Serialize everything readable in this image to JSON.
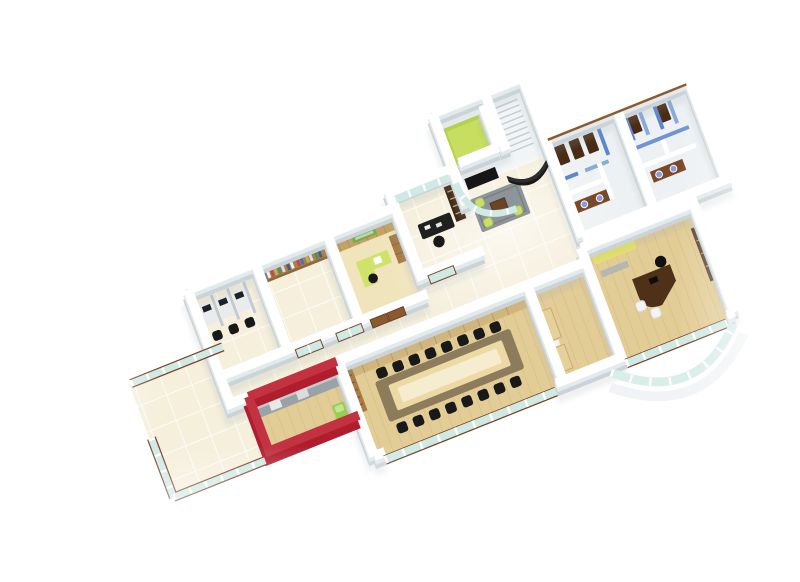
{
  "scene": {
    "description": "3D isometric cutaway render of an office floor plan on a white background, view from above at an angle, edges fading to white",
    "view": "isometric-cutaway",
    "background": "#ffffff"
  },
  "palette": {
    "wallTop": "#ffffff",
    "wallBase": "#c9d3d8",
    "wallShadow": "#9aa6ac",
    "tile": "#f5efdc",
    "grout": "#ffffff",
    "wood": "#e3cd97",
    "plank": "#b98d4e",
    "paleWood": "#f0e4bc",
    "glass": "#cfe9e5",
    "frameBrown": "#7b4426",
    "doorWood": "#8a5a2e",
    "doorWoodDark": "#5e3a1e",
    "furnDark": "#4e3118",
    "furnLight": "#d9b878",
    "furnLightEdge": "#b99a55",
    "shelfWood": "#a87b42",
    "tableTaupe": "#8d7c5c",
    "tableInset": "#ecd9a4",
    "tableCenter": "#f6ecd0",
    "black": "#191919",
    "red": "#b01e2e",
    "redTop": "#c23240",
    "counter": "#9aa2a8",
    "lime": "#b5d44a",
    "limeLight": "#cfe36a",
    "pouf": "#c7e06a",
    "signGreen": "#6fae3c",
    "dispenser": "#97cf52",
    "yellow": "#e9e468",
    "yellowDark": "#cfc84f",
    "blue": "#5d86cc",
    "blueLight": "#88abdd",
    "blueMid": "#6f94d4",
    "sink": "#8a9ae0",
    "toiletFloor": "#eef1f3",
    "whiteFloor": "#f2f5f6",
    "rug": "#8d949a",
    "rugEdge": "#798086",
    "chairWhite": "#f4f4f4",
    "partition": "#c3cad1",
    "deskTop": "#e9ebed",
    "monitor": "#1d2126",
    "steel": "#c5ced4",
    "benchWood": "#e6cf9a",
    "benchEdge": "#c9ab6a"
  },
  "rooms": [
    {
      "id": "workstations",
      "floor": "tile",
      "contents": [
        "3 desks with silver partitions",
        "black monitors",
        "black task chairs"
      ]
    },
    {
      "id": "library",
      "floor": "tile",
      "contents": [
        "full-width wall bookshelf with colored books"
      ]
    },
    {
      "id": "green-office",
      "floor": "pale-wood",
      "contents": [
        "wood panelled wall",
        "green wall sign",
        "lime L-shaped desk",
        "wood cabinet",
        "double wooden door"
      ]
    },
    {
      "id": "private-cabin",
      "floor": "tile",
      "contents": [
        "glazed back wall",
        "dark shelving unit",
        "black desk with papers",
        "glass door"
      ]
    },
    {
      "id": "reception-lounge",
      "floor": "tile",
      "contents": [
        "curved glass partition",
        "gray rug",
        "brown coffee table",
        "3 lime poufs",
        "black curved sofa",
        "dark doorway"
      ]
    },
    {
      "id": "stair-block",
      "floor": "white",
      "contents": [
        "staircase with steps",
        "lime-green landing room"
      ]
    },
    {
      "id": "toilets",
      "floor": "light-gray",
      "contents": [
        "dark wooden stall doors",
        "blue stall walls",
        "wash basin counters with blue sinks"
      ]
    },
    {
      "id": "pantry",
      "floor": "wood",
      "contents": [
        "red walls",
        "gray counter with appliances",
        "green water dispenser"
      ]
    },
    {
      "id": "conference-room",
      "floor": "wood",
      "contents": [
        "long taupe table with light inlay",
        "16 black chairs",
        "light wood credenza",
        "bookshelf",
        "front window band"
      ]
    },
    {
      "id": "lounge-cabin",
      "floor": "wood",
      "contents": [
        "2 light wood benches",
        "white side table"
      ]
    },
    {
      "id": "md-office",
      "floor": "wood",
      "contents": [
        "curved dark executive desk",
        "black desk chair",
        "2 white guest chairs",
        "yellow sofa",
        "tall credenza",
        "glass front",
        "curved facade"
      ]
    },
    {
      "id": "terrace",
      "floor": "tile",
      "contents": [
        "glass railing panels with brown frames"
      ]
    }
  ],
  "counts": {
    "conference_chairs": 16,
    "workstations": 3,
    "poufs": 3,
    "guest_chairs": 2,
    "toilet_wood_doors": 5
  }
}
